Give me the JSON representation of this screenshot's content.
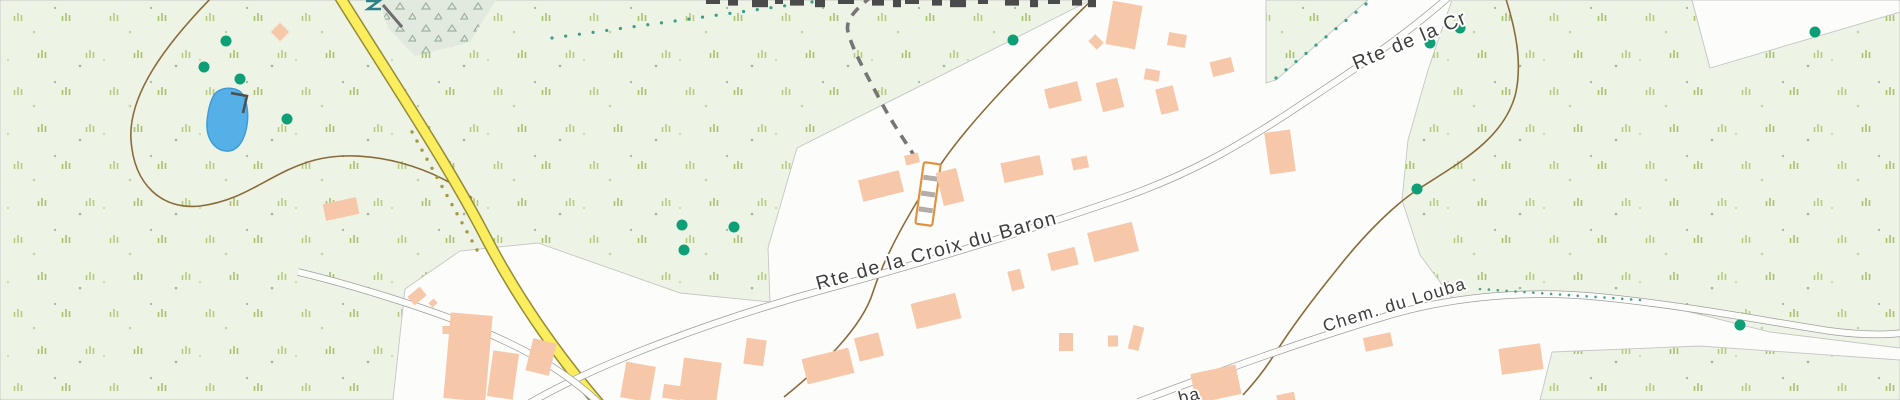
{
  "map": {
    "labels": {
      "road_main": "Rte de la Croix du Baron",
      "road_main_cutoff": "Rte de la Cr",
      "road_secondary": "Chem. du Louba",
      "road_secondary_partial": "ba"
    },
    "colors": {
      "forest_fill": "#edf4e5",
      "clearing_fill": "#fcfcfa",
      "building_fill": "#f7c7a9",
      "yellow_road_fill": "#fbee5e",
      "yellow_road_casing": "#968a35",
      "white_road_casing": "#9f9f9f",
      "path_brown": "#8a6b3a",
      "dashed_path_gray": "#767676",
      "tree_dot_teal": "#0f9f76",
      "pond_blue": "#55b0e8",
      "label_gray": "#3d3d3d",
      "tuft_olive": "#b7cb80",
      "boundary_gray": "#c6c6c6",
      "ladder_orange": "#e2913c"
    },
    "features": {
      "tree_dots": [
        [
          226,
          41
        ],
        [
          204,
          67
        ],
        [
          240,
          79
        ],
        [
          287,
          119
        ],
        [
          682,
          225
        ],
        [
          734,
          227
        ],
        [
          684,
          250
        ],
        [
          1013,
          40
        ],
        [
          1430,
          43
        ],
        [
          1460,
          28
        ],
        [
          1417,
          189
        ],
        [
          1740,
          325
        ],
        [
          1815,
          32
        ]
      ],
      "buildings": [
        [
          341,
          209,
          34,
          17,
          -12
        ],
        [
          280,
          32,
          13,
          13,
          45
        ],
        [
          417,
          296,
          16,
          11,
          -40
        ],
        [
          433,
          303,
          7,
          6,
          -40
        ],
        [
          447,
          330,
          9,
          8,
          0
        ],
        [
          468,
          357,
          42,
          86,
          5
        ],
        [
          503,
          375,
          26,
          46,
          8
        ],
        [
          541,
          357,
          24,
          33,
          14
        ],
        [
          638,
          382,
          30,
          36,
          10
        ],
        [
          700,
          381,
          38,
          42,
          8
        ],
        [
          672,
          392,
          18,
          14,
          8
        ],
        [
          755,
          352,
          20,
          26,
          8
        ],
        [
          828,
          366,
          48,
          26,
          -14
        ],
        [
          869,
          347,
          25,
          24,
          -14
        ],
        [
          936,
          311,
          46,
          26,
          -14
        ],
        [
          881,
          186,
          42,
          22,
          -14
        ],
        [
          950,
          187,
          21,
          34,
          -14
        ],
        [
          912,
          159,
          14,
          10,
          -14
        ],
        [
          1022,
          169,
          40,
          20,
          -12
        ],
        [
          1080,
          163,
          16,
          12,
          -12
        ],
        [
          1113,
          242,
          46,
          30,
          -14
        ],
        [
          1063,
          259,
          28,
          18,
          -14
        ],
        [
          1016,
          280,
          13,
          20,
          -14
        ],
        [
          1124,
          25,
          30,
          44,
          10
        ],
        [
          1177,
          40,
          18,
          13,
          10
        ],
        [
          1152,
          75,
          15,
          11,
          10
        ],
        [
          1096,
          42,
          12,
          10,
          45
        ],
        [
          1063,
          95,
          34,
          20,
          -14
        ],
        [
          1110,
          95,
          22,
          30,
          -14
        ],
        [
          1167,
          100,
          18,
          26,
          -14
        ],
        [
          1222,
          67,
          22,
          15,
          -14
        ],
        [
          1280,
          152,
          26,
          42,
          -8
        ],
        [
          1066,
          342,
          14,
          18,
          0
        ],
        [
          1113,
          341,
          10,
          11,
          0
        ],
        [
          1136,
          338,
          11,
          24,
          14
        ],
        [
          1216,
          384,
          46,
          30,
          -12
        ],
        [
          1286,
          398,
          18,
          9,
          -12
        ],
        [
          1378,
          342,
          28,
          14,
          -12
        ],
        [
          1521,
          359,
          42,
          26,
          -8
        ]
      ],
      "top_label_fragments": [
        [
          706,
          14
        ],
        [
          728,
          10
        ],
        [
          752,
          16
        ],
        [
          775,
          8
        ],
        [
          790,
          14
        ],
        [
          815,
          10
        ],
        [
          838,
          16
        ],
        [
          872,
          12
        ],
        [
          893,
          8
        ],
        [
          905,
          14
        ],
        [
          932,
          10
        ],
        [
          950,
          16
        ],
        [
          978,
          10
        ],
        [
          1005,
          14
        ],
        [
          1030,
          8
        ],
        [
          1048,
          12
        ],
        [
          1072,
          10
        ],
        [
          1088,
          8
        ]
      ]
    }
  }
}
